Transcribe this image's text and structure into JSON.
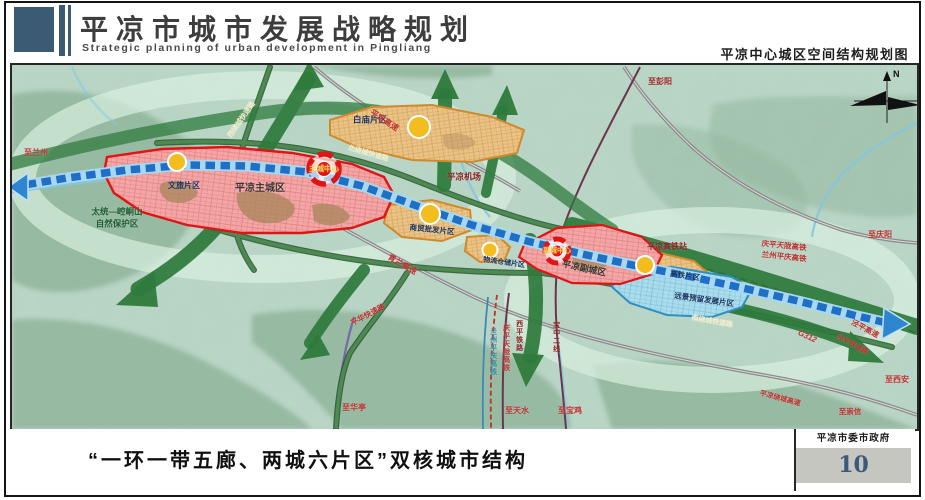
{
  "header": {
    "title_cn": "平凉市城市发展战略规划",
    "title_en": "Strategic planning of urban development in Pingliang",
    "map_title": "平凉中心城区空间结构规划图"
  },
  "footer": {
    "caption": "“一环一带五廊、两城六片区”双核城市结构",
    "agency": "平凉市委市政府",
    "page_number": "10"
  },
  "colors": {
    "brand_blue": "#3b5a74",
    "core_red": "#e01414",
    "zone_orange": "#cf8a2e",
    "belt_blue": "#1f6fc6",
    "corridor_green": "#2e7a3c"
  },
  "map": {
    "compass": "N",
    "labels": [
      {
        "name": "dest-lanzhou",
        "text": "至兰州",
        "x": 24,
        "y": 88,
        "size": 8,
        "color": "#c03a3a",
        "rotate": 0
      },
      {
        "name": "reserve-line1",
        "text": "太统—崆峒山",
        "x": 105,
        "y": 147,
        "size": 8.5,
        "color": "#1c5c30",
        "rotate": 0
      },
      {
        "name": "reserve-line2",
        "text": "自然保护区",
        "x": 105,
        "y": 159,
        "size": 8.5,
        "color": "#1c5c30",
        "rotate": 0
      },
      {
        "name": "zone-wenlv",
        "text": "文旅片区",
        "x": 172,
        "y": 121,
        "size": 8,
        "color": "#16305e",
        "bold": true,
        "rotate": 0
      },
      {
        "name": "zone-baimiao",
        "text": "白庙片区",
        "x": 358,
        "y": 55,
        "size": 8.5,
        "color": "#16305e",
        "bold": true,
        "rotate": 0
      },
      {
        "name": "road-west-ring",
        "text": "西绕城快速路",
        "x": 230,
        "y": 55,
        "size": 7,
        "color": "#f3eec9",
        "rotate": -55
      },
      {
        "name": "road-pingding",
        "text": "平定高速",
        "x": 372,
        "y": 56,
        "size": 8,
        "color": "#c03030",
        "rotate": 33
      },
      {
        "name": "road-north-ring",
        "text": "北绕城快速路",
        "x": 356,
        "y": 89,
        "size": 7,
        "color": "#f3eec9",
        "rotate": 16
      },
      {
        "name": "airport",
        "text": "平凉机场",
        "x": 452,
        "y": 112,
        "size": 8.5,
        "color": "#8b2020",
        "rotate": 0
      },
      {
        "name": "zone-main-city",
        "text": "平凉主城区",
        "x": 248,
        "y": 124,
        "size": 10,
        "color": "#3a3530",
        "bold": true,
        "rotate": 0
      },
      {
        "name": "core-main",
        "text": "主城中心",
        "x": 312,
        "y": 104,
        "size": 7.5,
        "color": "#ffd34d",
        "bold": true,
        "rotate": 0
      },
      {
        "name": "road-qinglan",
        "text": "青兰高速",
        "x": 390,
        "y": 200,
        "size": 8,
        "color": "#c03030",
        "rotate": 30
      },
      {
        "name": "zone-shangmao",
        "text": "商贸批发片区",
        "x": 420,
        "y": 165,
        "size": 7.5,
        "color": "#16305e",
        "bold": true,
        "rotate": 6
      },
      {
        "name": "zone-wuliu",
        "text": "物流仓储片区",
        "x": 492,
        "y": 198,
        "size": 7,
        "color": "#16305e",
        "bold": true,
        "rotate": 8
      },
      {
        "name": "zone-sub-city",
        "text": "平凉副城区",
        "x": 572,
        "y": 204,
        "size": 9,
        "color": "#3a3530",
        "bold": true,
        "rotate": 12
      },
      {
        "name": "core-sub",
        "text": "副城中心",
        "x": 545,
        "y": 186,
        "size": 7,
        "color": "#ffd34d",
        "bold": true,
        "rotate": 0
      },
      {
        "name": "hsr-station",
        "text": "平凉高铁站",
        "x": 655,
        "y": 182,
        "size": 8,
        "color": "#8b2020",
        "rotate": 0
      },
      {
        "name": "zone-gaotie",
        "text": "高铁片区",
        "x": 673,
        "y": 211,
        "size": 7.5,
        "color": "#16305e",
        "bold": true,
        "rotate": 8
      },
      {
        "name": "zone-yuanjing",
        "text": "远景预留发展片区",
        "x": 692,
        "y": 235,
        "size": 7.5,
        "color": "#16305e",
        "bold": true,
        "rotate": 8
      },
      {
        "name": "road-south-ring",
        "text": "南绕城快速路",
        "x": 700,
        "y": 257,
        "size": 7,
        "color": "#f3eec9",
        "rotate": 10
      },
      {
        "name": "rail-qptl",
        "text": "庆平天陇高铁",
        "x": 772,
        "y": 181,
        "size": 7.5,
        "color": "#c03030",
        "rotate": 6
      },
      {
        "name": "rail-lzpq",
        "text": "兰州平庆高铁",
        "x": 772,
        "y": 192,
        "size": 7.5,
        "color": "#c03030",
        "rotate": 6
      },
      {
        "name": "dest-pengyang",
        "text": "至彭阳",
        "x": 648,
        "y": 17,
        "size": 8,
        "color": "#a02525",
        "rotate": 0
      },
      {
        "name": "dest-qingyang",
        "text": "至庆阳",
        "x": 868,
        "y": 170,
        "size": 8,
        "color": "#c03030",
        "rotate": 0
      },
      {
        "name": "road-jingping",
        "text": "泾平高速",
        "x": 853,
        "y": 264,
        "size": 7.5,
        "color": "#c03030",
        "rotate": 28
      },
      {
        "name": "road-jingping-ks",
        "text": "泾平快速路",
        "x": 840,
        "y": 280,
        "size": 7,
        "color": "#c03030",
        "rotate": 28
      },
      {
        "name": "road-g312",
        "text": "G312",
        "x": 795,
        "y": 272,
        "size": 8,
        "color": "#c03030",
        "rotate": 24,
        "italic": true
      },
      {
        "name": "road-raocheng",
        "text": "平凉绕城高速",
        "x": 768,
        "y": 334,
        "size": 7,
        "color": "#c03030",
        "rotate": 15
      },
      {
        "name": "dest-xian",
        "text": "至西安",
        "x": 885,
        "y": 315,
        "size": 8,
        "color": "#c03030",
        "rotate": 0
      },
      {
        "name": "dest-chongxin",
        "text": "至崇信",
        "x": 838,
        "y": 347,
        "size": 7.5,
        "color": "#c03030",
        "rotate": 0
      },
      {
        "name": "rail-lzpq-v",
        "text": "兰州平庆高铁",
        "x": 481,
        "y": 287,
        "size": 7,
        "color": "#2a8aa5",
        "vertical": true
      },
      {
        "name": "rail-qptl-v",
        "text": "庆平天陇高铁",
        "x": 494,
        "y": 283,
        "size": 7,
        "color": "#c03030",
        "vertical": true
      },
      {
        "name": "rail-xiping-v",
        "text": "西平铁路",
        "x": 507,
        "y": 271,
        "size": 7,
        "color": "#8b2020",
        "vertical": true
      },
      {
        "name": "rail-baozhong-v",
        "text": "宝中二线",
        "x": 544,
        "y": 272,
        "size": 7,
        "color": "#8b2020",
        "vertical": true
      },
      {
        "name": "dest-tianshui",
        "text": "至天水",
        "x": 505,
        "y": 346,
        "size": 8,
        "color": "#c03030",
        "rotate": 0
      },
      {
        "name": "dest-baoji",
        "text": "至宝鸡",
        "x": 558,
        "y": 346,
        "size": 8,
        "color": "#c03030",
        "rotate": 0
      },
      {
        "name": "dest-huating",
        "text": "至华亭",
        "x": 342,
        "y": 343,
        "size": 8,
        "color": "#c03030",
        "rotate": 0
      },
      {
        "name": "road-pinghua",
        "text": "平华快速路",
        "x": 356,
        "y": 250,
        "size": 7.5,
        "color": "#c03030",
        "rotate": -28
      }
    ]
  }
}
